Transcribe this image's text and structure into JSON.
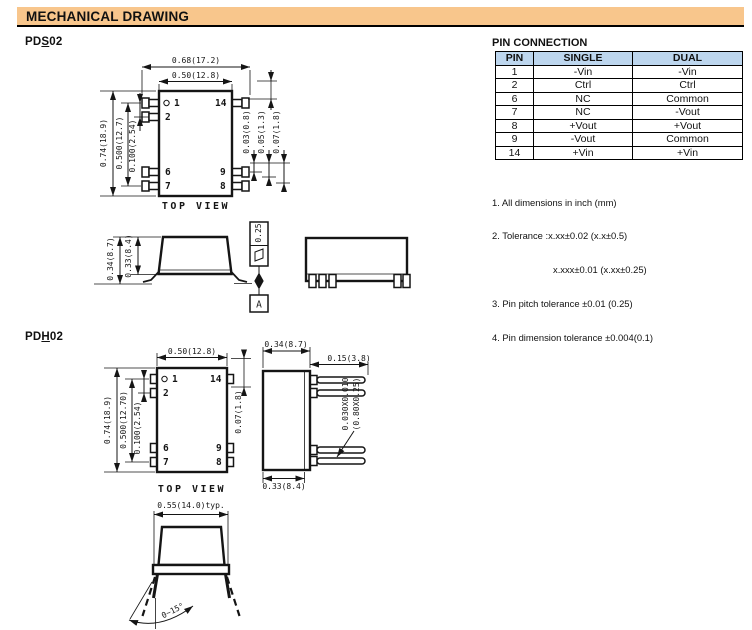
{
  "header": {
    "title": "MECHANICAL DRAWING"
  },
  "pds02": {
    "label": {
      "pre": "PD",
      "u": "S",
      "suf": "02"
    },
    "top": {
      "caption": "TOP VIEW",
      "pins": {
        "p1": "1",
        "p2": "2",
        "p6": "6",
        "p7": "7",
        "p8": "8",
        "p9": "9",
        "p14": "14"
      },
      "dims": {
        "overall": "0.68(17.2)",
        "body_w": "0.50(12.8)",
        "body_h": "0.74(18.9)",
        "span": "0.500(12.7)",
        "pitch": "0.100(2.54)",
        "lead1": "0.03(0.8)",
        "lead2": "0.05(1.3)",
        "lead3": "0.07(1.8)"
      }
    },
    "front": {
      "h_total": "0.34(8.7)",
      "h_body": "0.33(8.4)",
      "flatness": "0.25",
      "datum": "A"
    }
  },
  "pdh02": {
    "label": {
      "pre": "PD",
      "u": "H",
      "suf": "02"
    },
    "top": {
      "caption": "TOP VIEW",
      "pins": {
        "p1": "1",
        "p2": "2",
        "p6": "6",
        "p7": "7",
        "p8": "8",
        "p9": "9",
        "p14": "14"
      },
      "dims": {
        "body_w": "0.50(12.8)",
        "body_h": "0.74(18.9)",
        "span": "0.500(12.70)",
        "pitch": "0.100(2.54)",
        "offset": "0.07(1.8)"
      }
    },
    "side": {
      "depth": "0.34(8.7)",
      "pin_len": "0.15(3.8)",
      "sect1": "0.030X0.010",
      "sect2": "(0.80X0.25)",
      "depth_b": "0.33(8.4)"
    },
    "front": {
      "width": "0.55(14.0)typ.",
      "angle": "0~15°"
    }
  },
  "pin_table": {
    "title": "PIN CONNECTION",
    "headers": [
      "PIN",
      "SINGLE",
      "DUAL"
    ],
    "rows": [
      [
        "1",
        "-Vin",
        "-Vin"
      ],
      [
        "2",
        "Ctrl",
        "Ctrl"
      ],
      [
        "6",
        "NC",
        "Common"
      ],
      [
        "7",
        "NC",
        "-Vout"
      ],
      [
        "8",
        "+Vout",
        "+Vout"
      ],
      [
        "9",
        "-Vout",
        "Common"
      ],
      [
        "14",
        "+Vin",
        "+Vin"
      ]
    ]
  },
  "notes": {
    "n1": "1. All dimensions in inch (mm)",
    "n2": "2. Tolerance :x.xx±0.02 (x.x±0.5)",
    "n2b": "x.xxx±0.01 (x.xx±0.25)",
    "n3": "3. Pin pitch tolerance ±0.01 (0.25)",
    "n4": "4. Pin dimension tolerance ±0.004(0.1)"
  },
  "colors": {
    "header_bg": "#F8C68C",
    "table_header_bg": "#BDD6EE",
    "line": "#151515"
  }
}
